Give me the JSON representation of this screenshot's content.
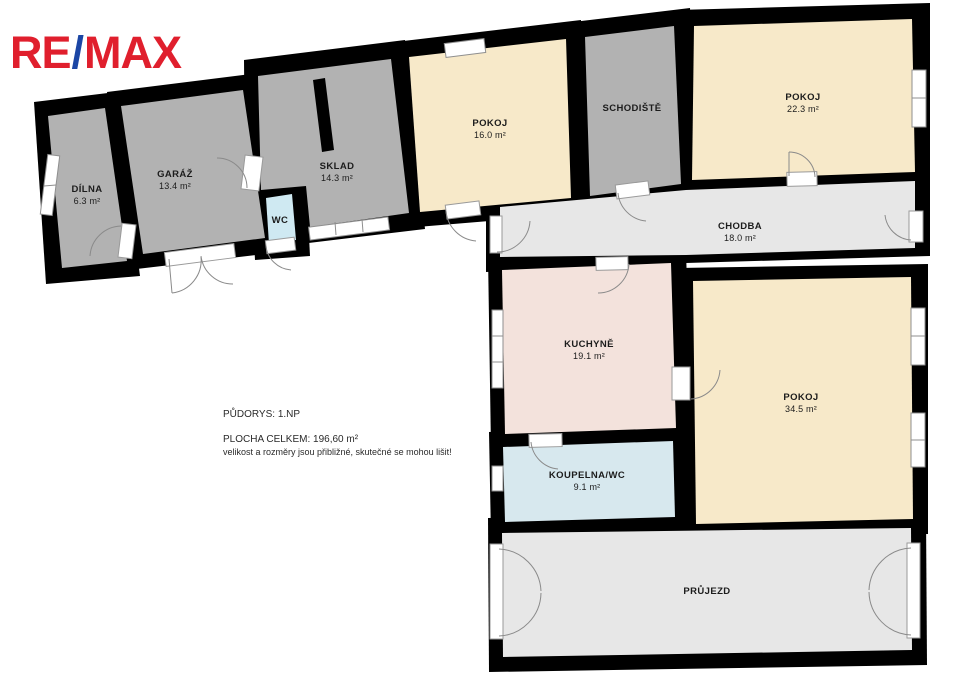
{
  "logo": {
    "part1": "RE",
    "slash": "/",
    "part2": "MAX",
    "red": "#e01f2d",
    "blue": "#1b46a5"
  },
  "rooms": {
    "dilna": {
      "name": "DÍLNA",
      "area": "6.3 m²"
    },
    "garaz": {
      "name": "GARÁŽ",
      "area": "13.4 m²"
    },
    "sklad": {
      "name": "SKLAD",
      "area": "14.3 m²"
    },
    "wc": {
      "name": "WC"
    },
    "pokoj16": {
      "name": "POKOJ",
      "area": "16.0 m²"
    },
    "schodiste": {
      "name": "SCHODIŠTĚ"
    },
    "pokoj22": {
      "name": "POKOJ",
      "area": "22.3 m²"
    },
    "chodba": {
      "name": "CHODBA",
      "area": "18.0 m²"
    },
    "kuchyne": {
      "name": "KUCHYNĚ",
      "area": "19.1 m²"
    },
    "pokoj34": {
      "name": "POKOJ",
      "area": "34.5 m²"
    },
    "koupelna": {
      "name": "KOUPELNA/WC",
      "area": "9.1 m²"
    },
    "prujezd": {
      "name": "PRŮJEZD"
    }
  },
  "annotation": {
    "line1": "PŮDORYS: 1.NP",
    "line2": "PLOCHA CELKEM:  196,60 m²",
    "line3": "velikost a rozměry jsou přibližné, skutečné se mohou lišit!"
  },
  "colors": {
    "wall": "#000000",
    "room_gray": "#b2b2b2",
    "room_cream": "#f7e9c9",
    "room_pink": "#f3e2dc",
    "room_blue_wc": "#cfe9f2",
    "room_blue_bath": "#d7e8ee",
    "corridor_gray": "#e7e7e7"
  }
}
